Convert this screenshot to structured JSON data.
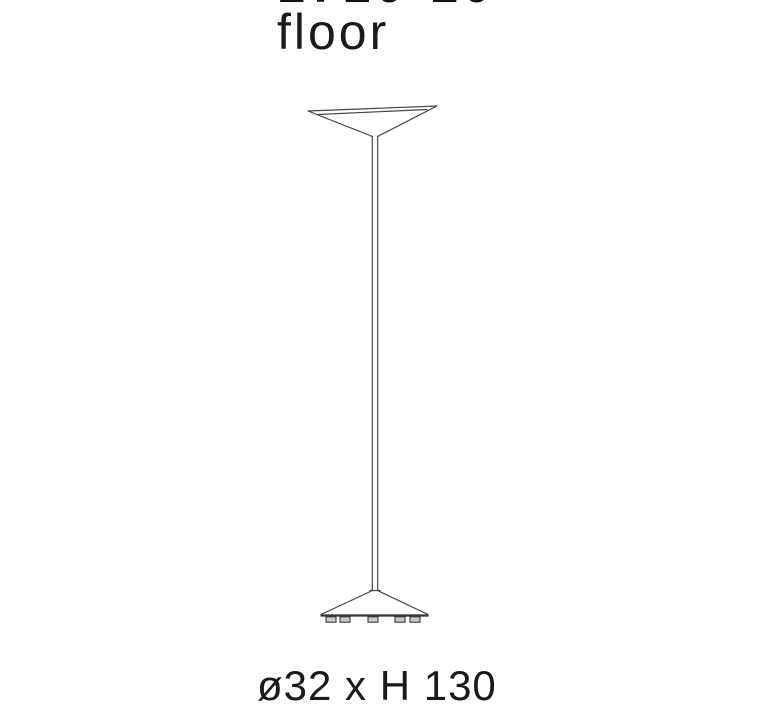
{
  "header": {
    "model": "1710-10",
    "variant": "floor"
  },
  "footer": {
    "dimensions": "ø32 x H 130"
  },
  "diagram": {
    "description": "technical line drawing of a floor lamp with conical uplight shade, thin stem and conical base with five feet",
    "line_color": "#454545",
    "text_color": "#1a1a1a",
    "background_color": "#ffffff"
  }
}
